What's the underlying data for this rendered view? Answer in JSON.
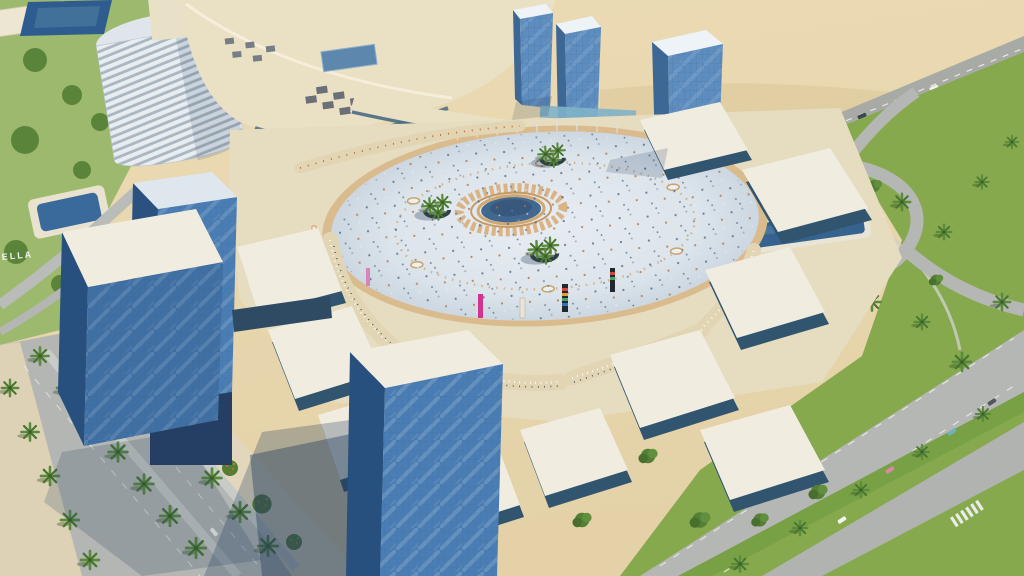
{
  "scene": {
    "description": "Aerial 3D architectural rendering of a desert mixed-use development: blue glass towers and white-roofed retail pavilions arranged radially around a large circular plaza with a central blue pool and ornamental tan ring, dining terraces, palm-lined boulevards and curving roads, a cylindrical resort tower and mall complex at upper left, and open desert with a palm-lined highway behind.",
    "hillside_sign_text": "ELLA",
    "elements": [
      "desert",
      "highway",
      "resort-district",
      "cylindrical-hotel-tower",
      "shopping-mall",
      "north-glass-towers",
      "central-plaza",
      "plaza-pool",
      "palm-clusters",
      "retail-pavilions",
      "dining-terraces",
      "foreground-glass-towers",
      "southwest-palm-boulevard",
      "east-road-network",
      "reflecting-pool"
    ]
  },
  "colors": {
    "sand": "#e8d6ae",
    "sand_streak": "#d9c193",
    "road": "#b3b6b2",
    "road_dark": "#a6a9a5",
    "lane_line": "#ecece8",
    "lawn": "#85a94c",
    "foliage": "#547f35",
    "palm": "#59853a",
    "mall_cream": "#eae0c4",
    "apron_cream": "#e6dcc0",
    "terrace_sand": "#e2d5b4",
    "plaza_paving": "#dbe3ea",
    "plaza_rim": "#d9bb8e",
    "mandala_tan": "#d3a770",
    "pool_blue": "#41688f",
    "east_pool_blue": "#35628f",
    "roof_white": "#f1ece0",
    "roof_top_light": "#dfe7ee",
    "glass_front": "#4a7db3",
    "glass_side": "#27507f",
    "glass_front_light": "#5d8cbe",
    "glass_side_light": "#3d6795",
    "glass_top": "#eef3f7",
    "clerestory_teal": "#9fc3cf",
    "dark_midrise": "#3f5668",
    "shadow_navy": "#1c3a5e",
    "banner_magenta": "#d1338f",
    "banner_dark": "#23282e",
    "flower_orange": "#d4692c",
    "sidewalk_cream": "#ddd2b6"
  }
}
